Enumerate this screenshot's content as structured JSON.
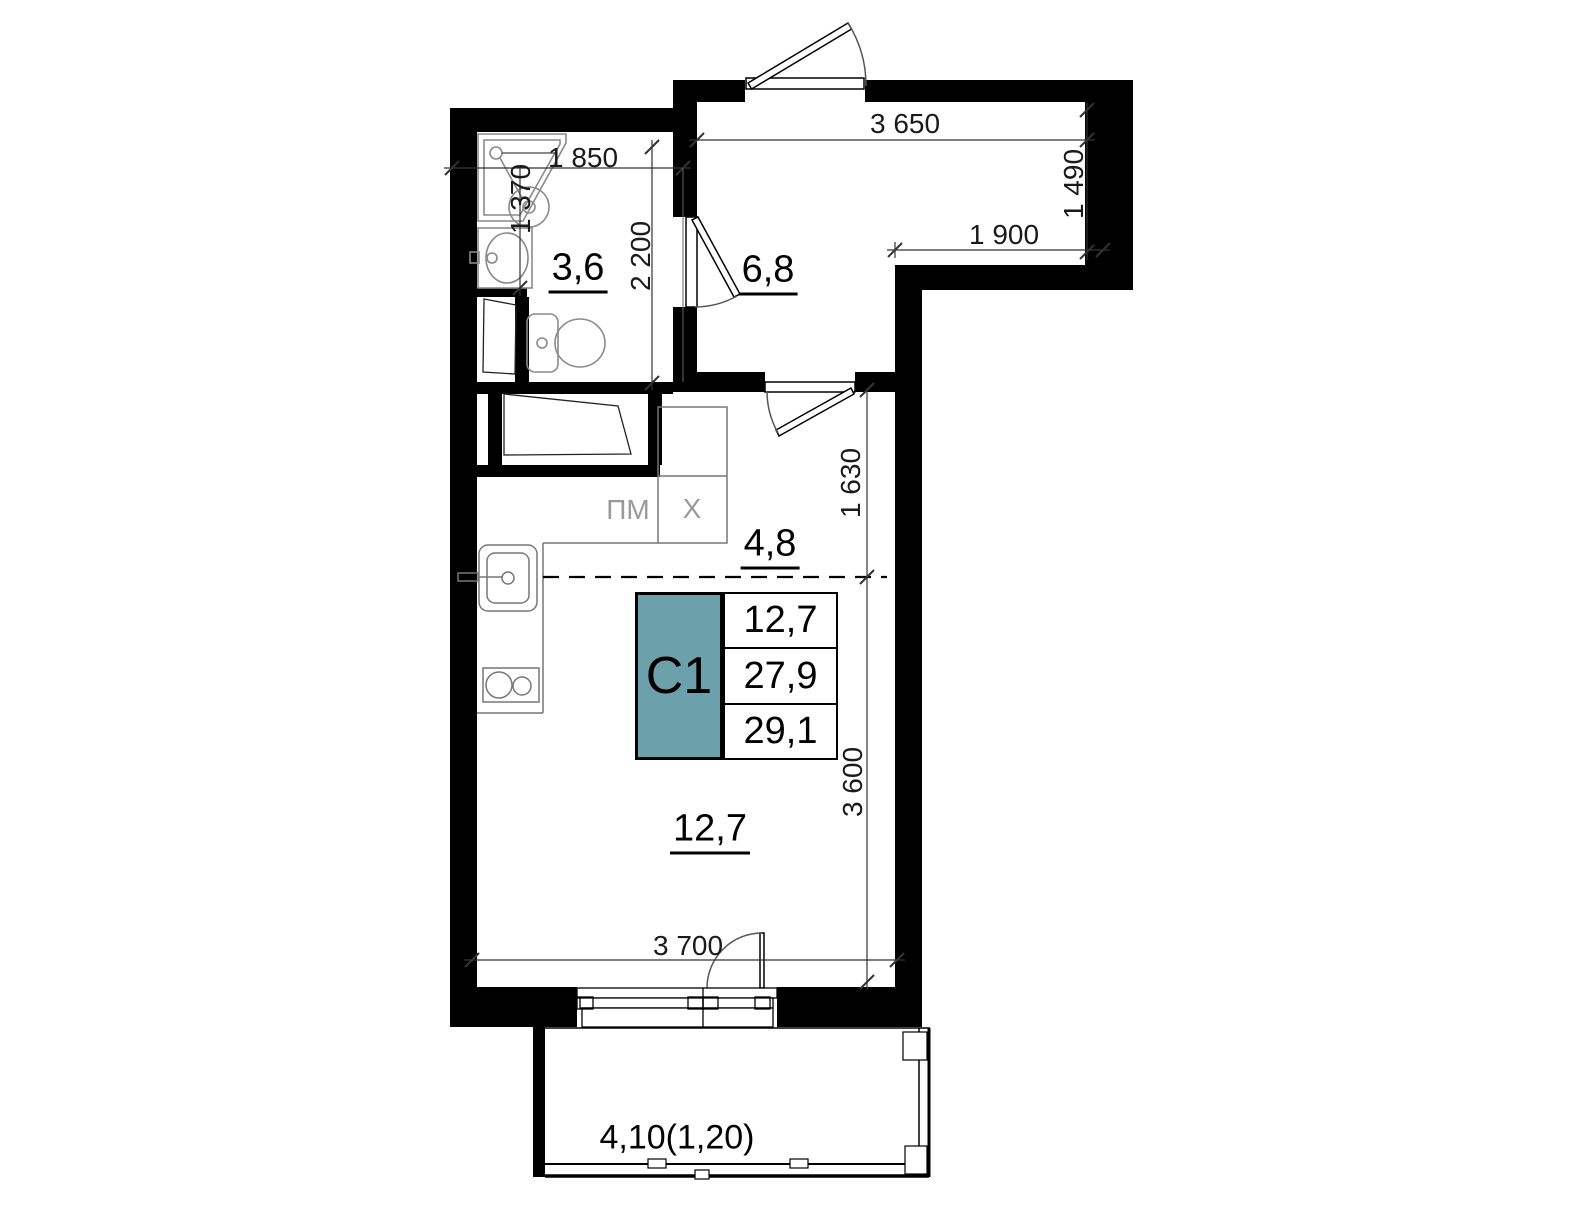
{
  "title": "Studio apartment floor plan",
  "unit_table": {
    "code": "C1",
    "row1": "12,7",
    "row2": "27,9",
    "row3": "29,1"
  },
  "rooms": {
    "bathroom": "3,6",
    "hall": "6,8",
    "kitchen": "4,8",
    "living": "12,7",
    "balcony": "4,10(1,20)"
  },
  "dims": {
    "d1850": "1 850",
    "d1370": "1 370",
    "d2200": "2 200",
    "d3650": "3 650",
    "d1490": "1 490",
    "d1900": "1 900",
    "d1630": "1 630",
    "d3600": "3 600",
    "d3700": "3 700"
  },
  "appliances": {
    "dishwasher": "ПМ",
    "fridge": "X"
  },
  "colors": {
    "wall": "#000000",
    "accent_teal": "#6CA0AA",
    "dim_text": "#1a1a1a",
    "symbol_stroke": "#8a8a8a",
    "appliance_text": "#9a9a9a"
  }
}
